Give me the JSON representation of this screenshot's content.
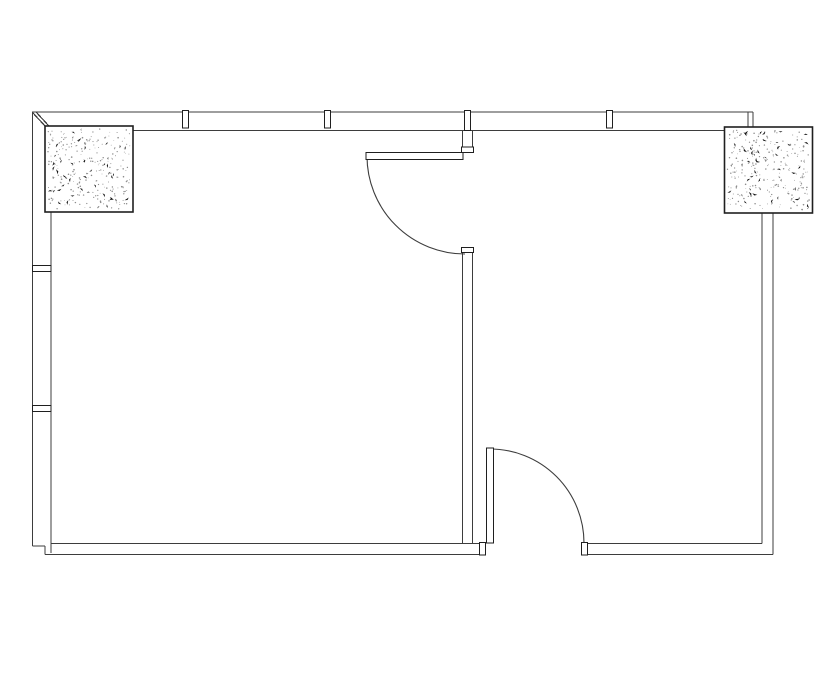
{
  "drawing": {
    "kind": "architectural-floor-plan",
    "canvas": {
      "width": 835,
      "height": 678
    },
    "colors": {
      "background": "#ffffff",
      "wall_line": "#3d3d3d",
      "detail_line": "#1f1f1f",
      "fill": "#ffffff",
      "stipple_fine": "#8c8c8c",
      "stipple_bold": "#141414"
    },
    "walls": {
      "lines": [
        {
          "name": "top-wall-outer-line",
          "x1": 32,
          "y1": 112,
          "x2": 753,
          "y2": 112
        },
        {
          "name": "top-wall-inner-line",
          "x1": 133,
          "y1": 130.5,
          "x2": 725,
          "y2": 130.5
        },
        {
          "name": "top-wall-right-end-cap-a",
          "x1": 748,
          "y1": 112,
          "x2": 748,
          "y2": 127
        },
        {
          "name": "top-wall-right-end-cap-b",
          "x1": 753,
          "y1": 112,
          "x2": 753,
          "y2": 127
        },
        {
          "name": "left-wall-outer-line",
          "x1": 32.5,
          "y1": 112,
          "x2": 32.5,
          "y2": 546
        },
        {
          "name": "left-wall-inner-line",
          "x1": 51,
          "y1": 212,
          "x2": 51,
          "y2": 553
        },
        {
          "name": "top-left-corner-bevel-a",
          "x1": 32.5,
          "y1": 112.5,
          "x2": 46,
          "y2": 127
        },
        {
          "name": "top-left-corner-bevel-b",
          "x1": 36,
          "y1": 112,
          "x2": 48.5,
          "y2": 125.5
        },
        {
          "name": "bottom-left-corner-hook-h",
          "x1": 32.5,
          "y1": 546,
          "x2": 45,
          "y2": 546
        },
        {
          "name": "bottom-left-corner-hook-v",
          "x1": 45,
          "y1": 546,
          "x2": 45,
          "y2": 554.5
        },
        {
          "name": "bottom-wall-left-top-line",
          "x1": 51,
          "y1": 543.5,
          "x2": 480,
          "y2": 543.5
        },
        {
          "name": "bottom-wall-left-bottom-line",
          "x1": 45,
          "y1": 554.5,
          "x2": 480,
          "y2": 554.5
        },
        {
          "name": "bottom-wall-right-top-line",
          "x1": 584,
          "y1": 543.5,
          "x2": 762,
          "y2": 543.5
        },
        {
          "name": "bottom-wall-right-bottom-line",
          "x1": 584,
          "y1": 554.5,
          "x2": 773,
          "y2": 554.5
        },
        {
          "name": "right-wall-inner-line",
          "x1": 762,
          "y1": 213,
          "x2": 762,
          "y2": 543.5
        },
        {
          "name": "right-wall-outer-line",
          "x1": 773,
          "y1": 213,
          "x2": 773,
          "y2": 554.5
        },
        {
          "name": "interior-wall-stub-left-line",
          "x1": 462.5,
          "y1": 130.5,
          "x2": 462.5,
          "y2": 148
        },
        {
          "name": "interior-wall-stub-right-line",
          "x1": 472.5,
          "y1": 130.5,
          "x2": 472.5,
          "y2": 148
        },
        {
          "name": "interior-wall-left-line",
          "x1": 462.5,
          "y1": 251,
          "x2": 462.5,
          "y2": 543.5
        },
        {
          "name": "interior-wall-right-line",
          "x1": 472.5,
          "y1": 251,
          "x2": 472.5,
          "y2": 543.5
        }
      ],
      "caps": [
        {
          "name": "interior-wall-stub-cap",
          "x": 461.5,
          "y": 147,
          "w": 12,
          "h": 5.5
        },
        {
          "name": "interior-wall-top-cap",
          "x": 461.5,
          "y": 247.5,
          "w": 12,
          "h": 5
        },
        {
          "name": "door-opening-left-jamb-cap",
          "x": 479.5,
          "y": 542.5,
          "w": 6,
          "h": 12.5
        },
        {
          "name": "door-opening-right-jamb-cap",
          "x": 581.5,
          "y": 542.5,
          "w": 6,
          "h": 12.5
        }
      ]
    },
    "mullions": [
      {
        "name": "top-wall-mullion-1",
        "x": 182.5,
        "y": 110.5,
        "w": 6,
        "h": 17.5
      },
      {
        "name": "top-wall-mullion-2",
        "x": 324.5,
        "y": 110.5,
        "w": 6,
        "h": 17.5
      },
      {
        "name": "top-wall-mullion-3",
        "x": 464.5,
        "y": 110.5,
        "w": 6,
        "h": 20
      },
      {
        "name": "top-wall-mullion-4",
        "x": 606.5,
        "y": 110.5,
        "w": 6,
        "h": 17.5
      },
      {
        "name": "left-wall-mullion-1",
        "x": 32.5,
        "y": 265.5,
        "w": 18.5,
        "h": 6
      },
      {
        "name": "left-wall-mullion-2",
        "x": 32.5,
        "y": 405.5,
        "w": 18.5,
        "h": 6
      }
    ],
    "columns": [
      {
        "name": "column-top-left",
        "x": 45,
        "y": 126,
        "w": 88,
        "h": 86,
        "seed": 7,
        "fine_count": 250,
        "bold_count": 44
      },
      {
        "name": "column-top-right",
        "x": 724.5,
        "y": 127,
        "w": 88,
        "h": 86,
        "seed": 23,
        "fine_count": 250,
        "bold_count": 44
      }
    ],
    "doors": [
      {
        "name": "door-top-interior",
        "leaf": {
          "x": 366,
          "y": 152.5,
          "w": 97,
          "h": 7
        },
        "arc": {
          "d": "M 367 156 A 98 98 0 0 0 465 254"
        }
      },
      {
        "name": "door-bottom-exterior",
        "leaf": {
          "x": 486.5,
          "y": 448,
          "w": 7,
          "h": 95
        },
        "arc": {
          "d": "M 490 449 A 94 94 0 0 1 584 543"
        }
      }
    ]
  }
}
